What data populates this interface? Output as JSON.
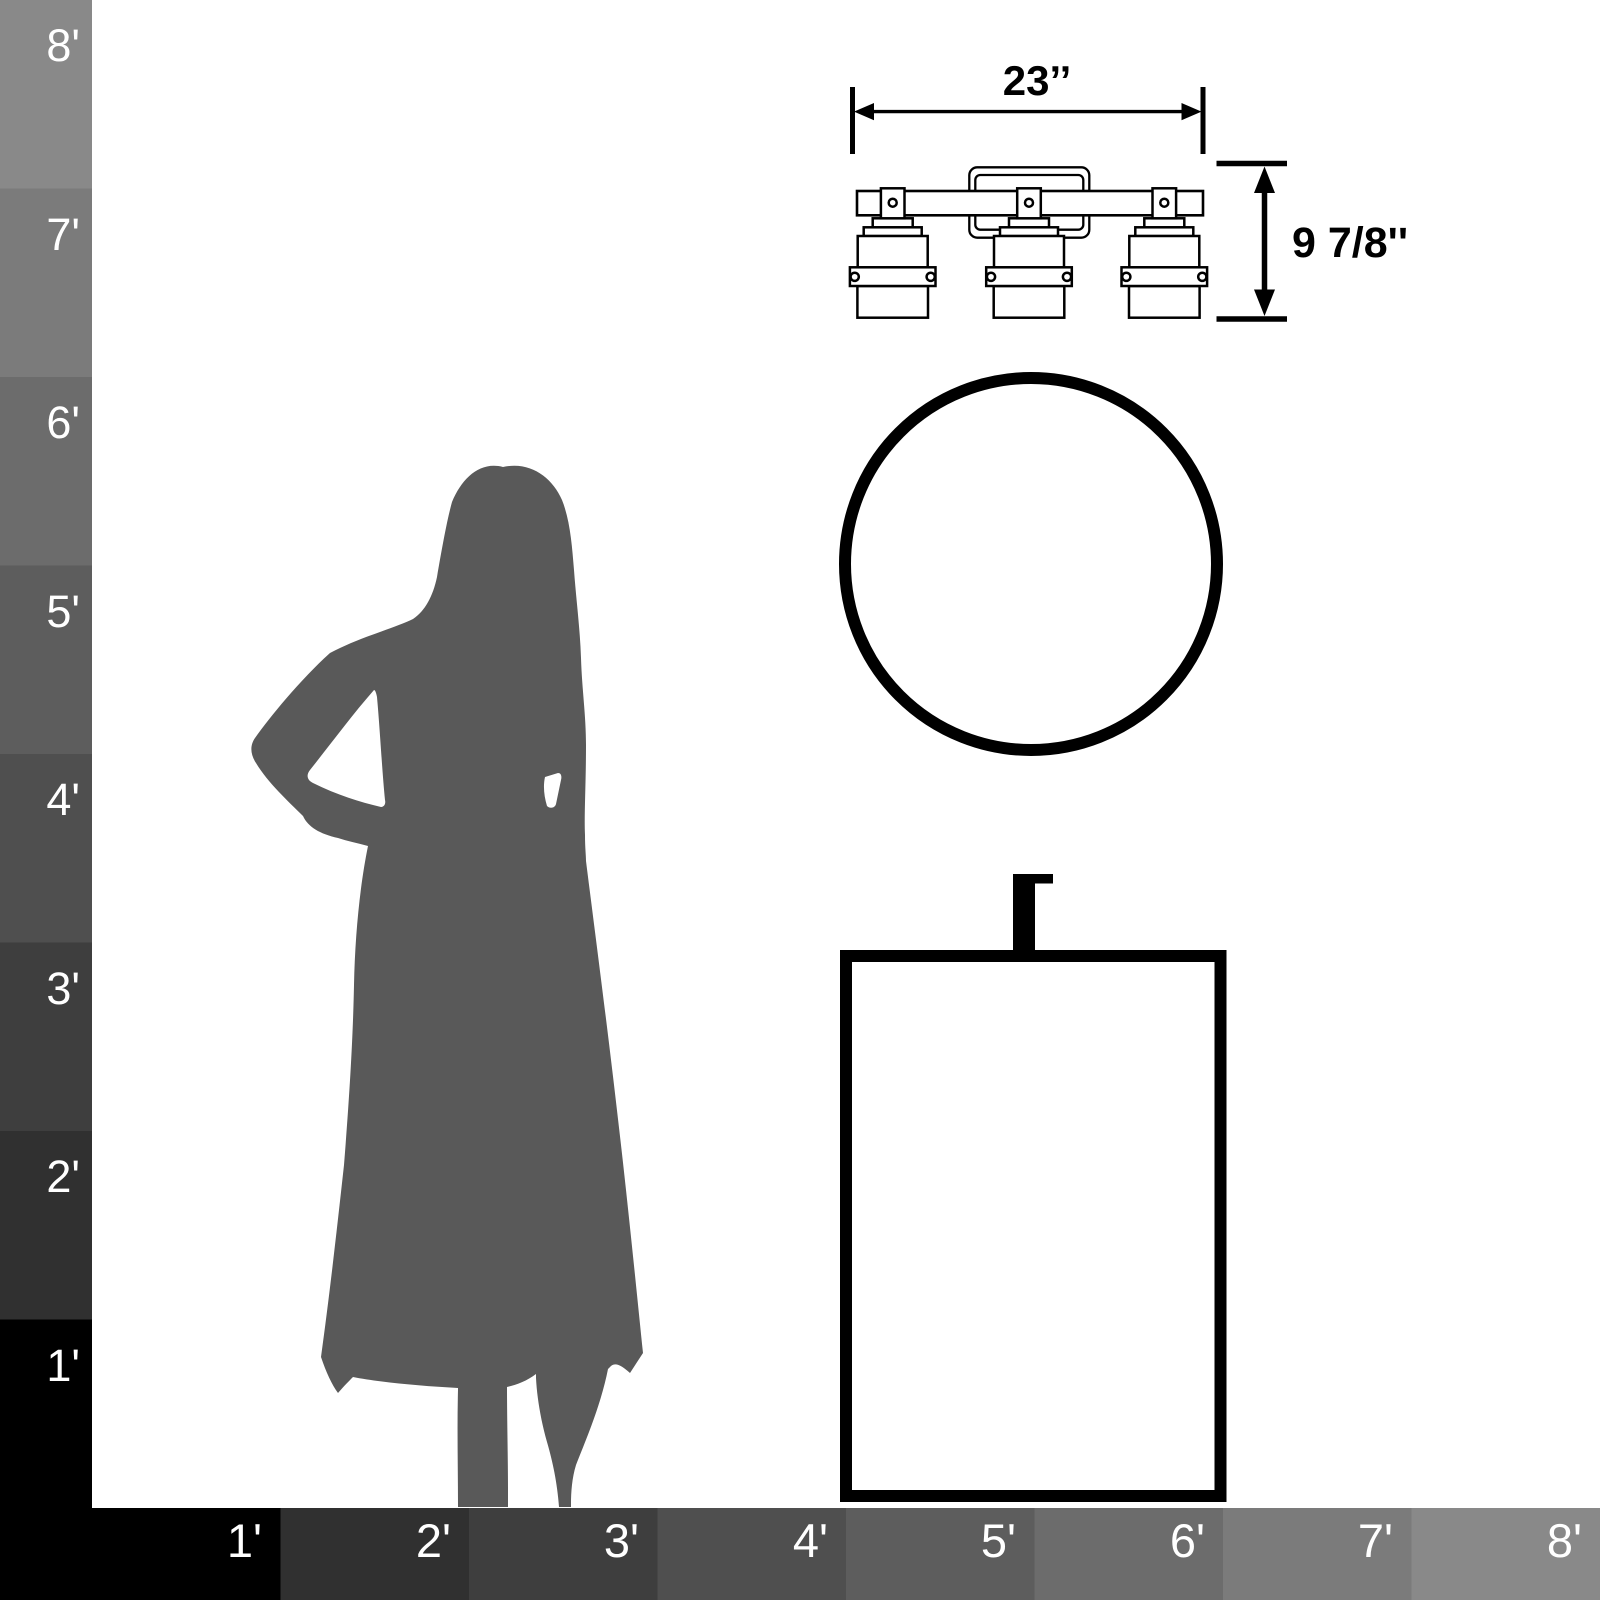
{
  "diagram": {
    "kind": "product scale reference",
    "objects": [
      "vanity light fixture drawing",
      "round mirror drawing",
      "vanity cabinet with faucet drawing",
      "woman silhouette"
    ]
  },
  "fixture": {
    "width_label": "23’’",
    "height_label": "9 7/8''"
  },
  "rulers": {
    "left": {
      "labels": [
        "8'",
        "7'",
        "6'",
        "5'",
        "4'",
        "3'",
        "2'",
        "1'"
      ]
    },
    "bottom": {
      "labels": [
        "1'",
        "2'",
        "3'",
        "4'",
        "5'",
        "6'",
        "7'",
        "8'"
      ]
    },
    "shades": {
      "f1": "#000000",
      "f2": "#303030",
      "f3": "#3e3e3e",
      "f4": "#4f4f4f",
      "f5": "#5d5d5d",
      "f6": "#6c6c6c",
      "f7": "#7b7b7b",
      "f8": "#898989"
    }
  },
  "colors": {
    "background": "#ffffff",
    "line": "#000000",
    "silhouette": "#595959",
    "ruler_text": "#ffffff"
  }
}
